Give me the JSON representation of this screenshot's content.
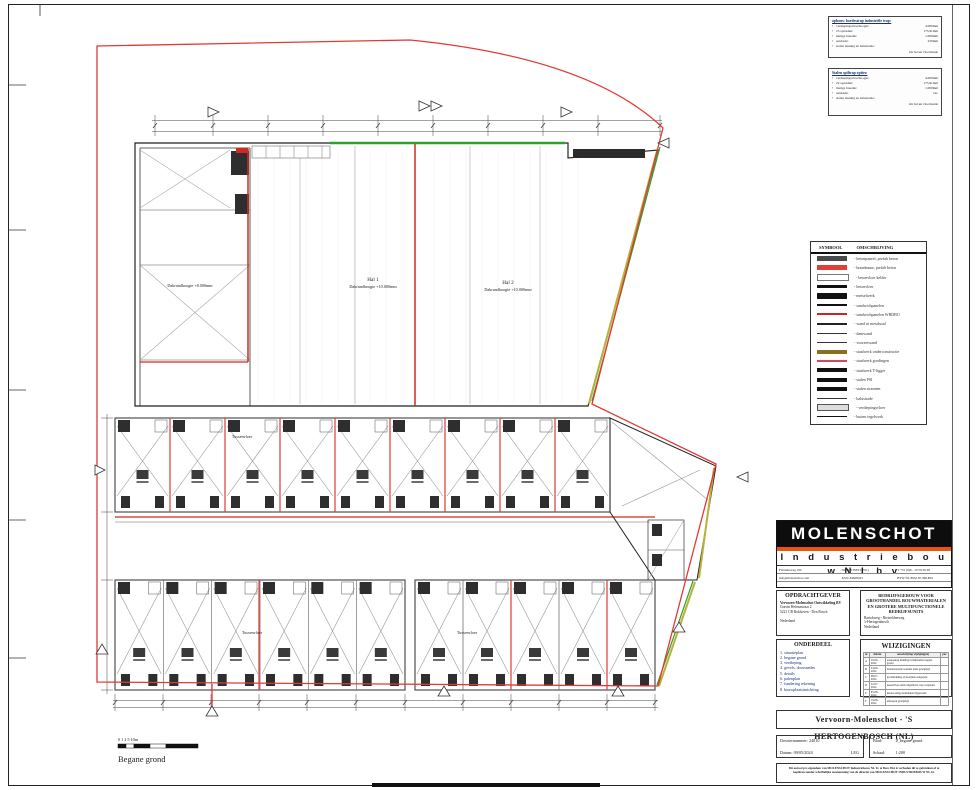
{
  "notes": [
    {
      "title": "opbouw bordestrap industriële trap:",
      "items": [
        {
          "label": "verdiepingsvloerhoogte:",
          "value": "4.000mm"
        },
        {
          "label": "23 optreden:",
          "value": "173,91mm"
        },
        {
          "label": "matige breedte:",
          "value": "1.000mm"
        },
        {
          "label": "aantrede:",
          "value": "250mm"
        },
        {
          "label": "stalen leuning en balustrade:",
          "value": ""
        },
        {
          "label": "",
          "value": "1m boven vloerbande"
        }
      ]
    },
    {
      "title": "Stalen spiltrap opties:",
      "items": [
        {
          "label": "verdiepingsvloerhoogte:",
          "value": "4.000mm"
        },
        {
          "label": "22 optreden:",
          "value": "173,91mm"
        },
        {
          "label": "matige breedte:",
          "value": "1.000mm"
        },
        {
          "label": "aantrede:",
          "value": "var."
        },
        {
          "label": "stalen leuning en balustrade:",
          "value": ""
        },
        {
          "label": "",
          "value": "1m boven vloerbande"
        }
      ]
    }
  ],
  "legend": {
    "header": {
      "symbol": "SYMBOOL",
      "description": "OMSCHRIJVING"
    },
    "rows": [
      {
        "swatch": "bar-dark",
        "desc": "- betonpaneel, prefab beton"
      },
      {
        "swatch": "bar-red",
        "desc": "- brandmuur, prefab beton"
      },
      {
        "swatch": "bar-outline",
        "desc": "- betonvloer kelder"
      },
      {
        "swatch": "bar-thinblack",
        "desc": "- betonvloer"
      },
      {
        "swatch": "bar-thickblack",
        "desc": "- metselwerk"
      },
      {
        "swatch": "line-black",
        "desc": "- sandwichpanelen"
      },
      {
        "swatch": "line-red",
        "desc": "- sandwichpanelen WBDBO"
      },
      {
        "swatch": "line-medium",
        "desc": "- wand in metalstud"
      },
      {
        "swatch": "line-thin",
        "desc": "- damwand"
      },
      {
        "swatch": "line-thin",
        "desc": "- voorzetwand"
      },
      {
        "swatch": "bar-brown",
        "desc": "- staalwerk onderconstructie"
      },
      {
        "swatch": "line-pink",
        "desc": "- staalwerk gordingen"
      },
      {
        "swatch": "bar-black",
        "desc": "- staalwerk T-ligger"
      },
      {
        "swatch": "bar-black",
        "desc": "- stalen PSI"
      },
      {
        "swatch": "bar-black",
        "desc": "- stalen stramien"
      },
      {
        "swatch": "line-thin",
        "desc": "- balustrade"
      },
      {
        "swatch": "bar-outline2",
        "desc": "- verdiepingsvloer"
      },
      {
        "swatch": "line-black",
        "desc": "- buiten tegelwerk"
      }
    ]
  },
  "plan": {
    "labels": {
      "left_hall": "Dakrandhoogte +8.000mm",
      "hal1_name": "Hal 1",
      "hal1_sub": "Dakrandhoogte +10.000mm",
      "hal2_name": "Hal 2",
      "hal2_sub": "Dakrandhoogte +10.000mm",
      "mezz1": "Tussenvloer",
      "mezz2": "Tussenvloer",
      "mezz3": "Tussenvloer",
      "scale_ticks": "0 1 2 5 10m",
      "floor_label": "Begane grond"
    }
  },
  "titleblock": {
    "brand": "MOLENSCHOT",
    "brand_sub": "I n d u s t r i e b o u w   N L   b v",
    "contact": {
      "address": "Fabrieksweg 19C",
      "city": "5684PN BEST (NL)",
      "phone": "T +31 (0)6 - 10 59 26 28",
      "email": "info@molenschot.com",
      "kvk": "KVK 84628423",
      "btw": "BTW NL 8632.87.366.B01"
    },
    "opdrachtgever": {
      "title": "OPDRACHTGEVER",
      "name": "Vervoorn-Molenschot Ontwikkeling BV",
      "lines": [
        "Gravin Helenastraat 2",
        "5221 CB Bokhoven - Den Bosch"
      ],
      "country": "Nederland"
    },
    "project": {
      "title": "BEDRIJFSGEBOUW VOOR GROOTHANDEL BOUWMATERIALEN EN GROTERE MULTIFUNCTIONELE BEDRIJFSUNITS",
      "lines": [
        "Bartokweg - Rietveldenweg",
        "'s-Hertogenbosch"
      ],
      "country": "Nederland"
    },
    "onderdeel": {
      "title": "ONDERDEEL",
      "items": [
        "1. situatieplan",
        "2. begane grond",
        "3. verdieping",
        "4. gevels, doorsnedes",
        "5. details",
        "6. palenplan",
        "7. fundering tekening",
        "8. bouwplaatsinrichting"
      ]
    },
    "wijzigingen": {
      "title": "WIJZIGINGEN",
      "columns": [
        "nr",
        "datum",
        "omschrijving wijziging(en)",
        "par."
      ],
      "rows": [
        [
          "A",
          "10-06-2024",
          "aanpassing indeling bedrijfsunits begane grond",
          ""
        ],
        [
          "B",
          "24-06-2024",
          "brandwerende wanden units gewijzigd",
          ""
        ],
        [
          "C",
          "08-07-2024",
          "gevelindeling en kozijnen aangepast",
          ""
        ],
        [
          "D",
          "22-07-2024",
          "tussenvloer units uitgebreid, trap verplaatst",
          ""
        ],
        [
          "E",
          "05-08-2024",
          "maatvoering stramienen bijgewerkt",
          ""
        ],
        [
          "F",
          "19-08-2024",
          "entreepui gewijzigd",
          ""
        ]
      ]
    },
    "project_title": "Vervoorn-Molenschot - 'S HERTOGENBOSCH (NL)",
    "dossier": {
      "number_label": "Dossiernummer:",
      "number": "24010",
      "date_label": "Datum:",
      "date": "09/05/2024",
      "author": "LEG"
    },
    "sheet": {
      "blad_label": "Blad:",
      "blad": "2_begane grond",
      "schaal_label": "Schaal:",
      "schaal": "1:200"
    },
    "disclaimer": "Dit ontwerp is eigendom van MOLENSCHOT Industriebouw NL bv te Best. Het is verboden dit te gebruiken of te kopiëren zonder schriftelijke toestemming van de directie van MOLENSCHOT INDUSTRIEBOUW NL bv."
  },
  "colors": {
    "boundary_red": "#e03a34",
    "accent_green": "#2da12d",
    "accent_olive": "#b7b23a",
    "logo_orange": "#e8560f",
    "note_blue": "#1a2f7a"
  }
}
